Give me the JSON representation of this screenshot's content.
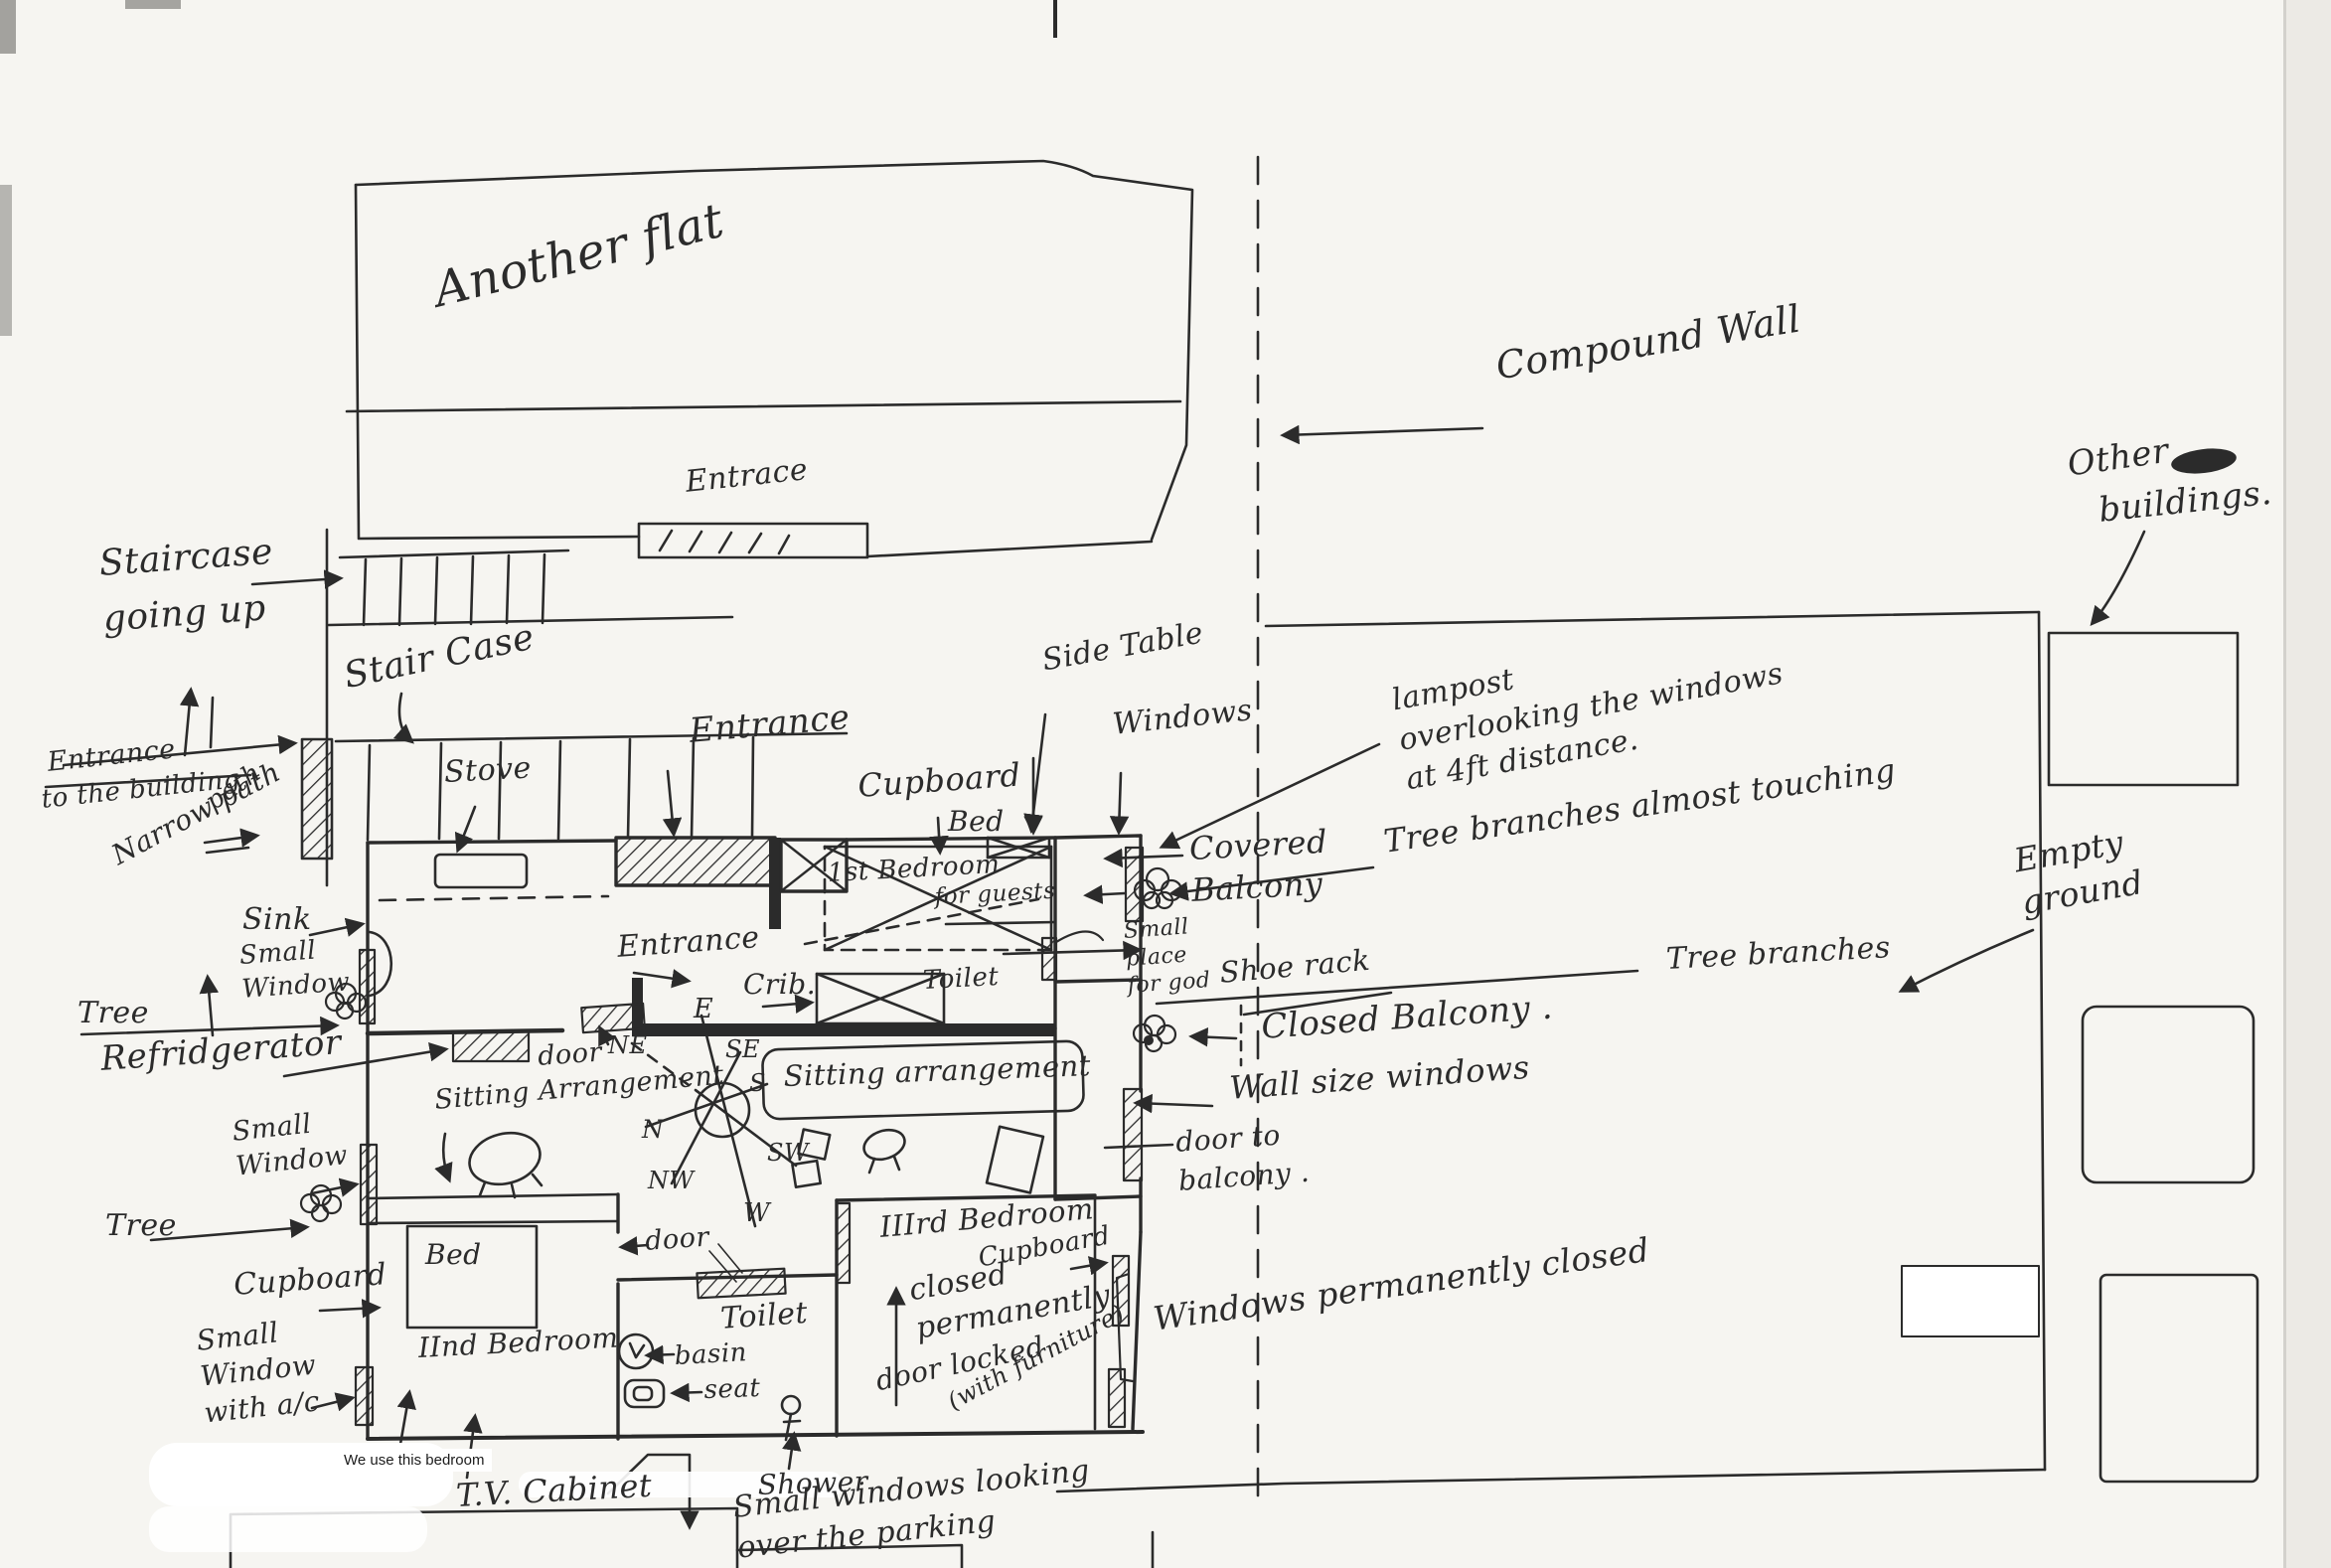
{
  "document": {
    "kind": "hand-drawn floor plan sketch"
  },
  "colors": {
    "ink": "#2b2b2b",
    "paper": "#f6f5f1"
  },
  "labels": {
    "another_flat": "Another flat",
    "flat_entrace": "Entrace",
    "compound_wall": "Compound Wall",
    "other_buildings_1": "Other",
    "other_buildings_2": "buildings.",
    "staircase_going_up": "Staircase\ngoing up",
    "stair_case": "Stair Case",
    "entrance_to_building_1": "Entrance",
    "entrance_to_building_2": "to the building",
    "entrance_path_word": "path",
    "narrow_path": "Narrow path",
    "stove": "Stove",
    "entrance_top": "Entrance",
    "side_table": "Side Table",
    "windows_top": "Windows",
    "cupboard_top": "Cupboard",
    "bed_top": "Bed",
    "guest_bedroom_1": "1st Bedroom",
    "guest_bedroom_2": "for guests",
    "lampost_note": "lampost\noverlooking the windows\nat 4ft distance.",
    "covered_balcony": "Covered\nBalcony",
    "tree_branches_touching": "Tree branches almost touching",
    "god_place": "Small\nplace\nfor god",
    "sink": "Sink",
    "small_window_kitchen": "Small\nWindow",
    "tree_upper": "Tree",
    "refrigerator": "Refridgerator",
    "entrance_inner": "Entrance",
    "crib": "Crib.",
    "toilet_1": "Toilet",
    "door_kitchen": "door",
    "sitting_arrangement_label": "Sitting Arrangement",
    "sitting_arrangement_box": "Sitting arrangement",
    "shoe_rack": "Shoe rack",
    "closed_balcony": "Closed Balcony .",
    "wall_size_windows": "Wall size windows",
    "door_to_balcony": "door to\nbalcony .",
    "tree_branches": "Tree branches",
    "empty_ground": "Empty\nground",
    "small_window_living": "Small\nWindow",
    "tree_lower": "Tree",
    "cupboard_left": "Cupboard",
    "bed_2": "Bed",
    "second_bedroom": "IInd Bedroom",
    "small_window_ac": "Small\nWindow\nwith a/c",
    "typed_note": "We use this bedroom",
    "tv_cabinet": "T.V. Cabinet",
    "door_living": "door",
    "toilet_2": "Toilet",
    "basin": "basin",
    "seat": "seat",
    "third_bedroom": "IIIrd Bedroom",
    "closed_permanently": "closed\npermanently",
    "door_locked": "door locked",
    "with_furniture": "(with furniture)",
    "cupboard_3rd": "Cupboard",
    "windows_permanently_closed": "Windows permanently closed",
    "shower": "Shower",
    "small_windows_parking": "Small windows looking over the parking"
  },
  "compass": {
    "n": "N",
    "ne": "NE",
    "e": "E",
    "se": "SE",
    "s": "S",
    "sw": "SW",
    "w": "W",
    "nw": "NW"
  }
}
